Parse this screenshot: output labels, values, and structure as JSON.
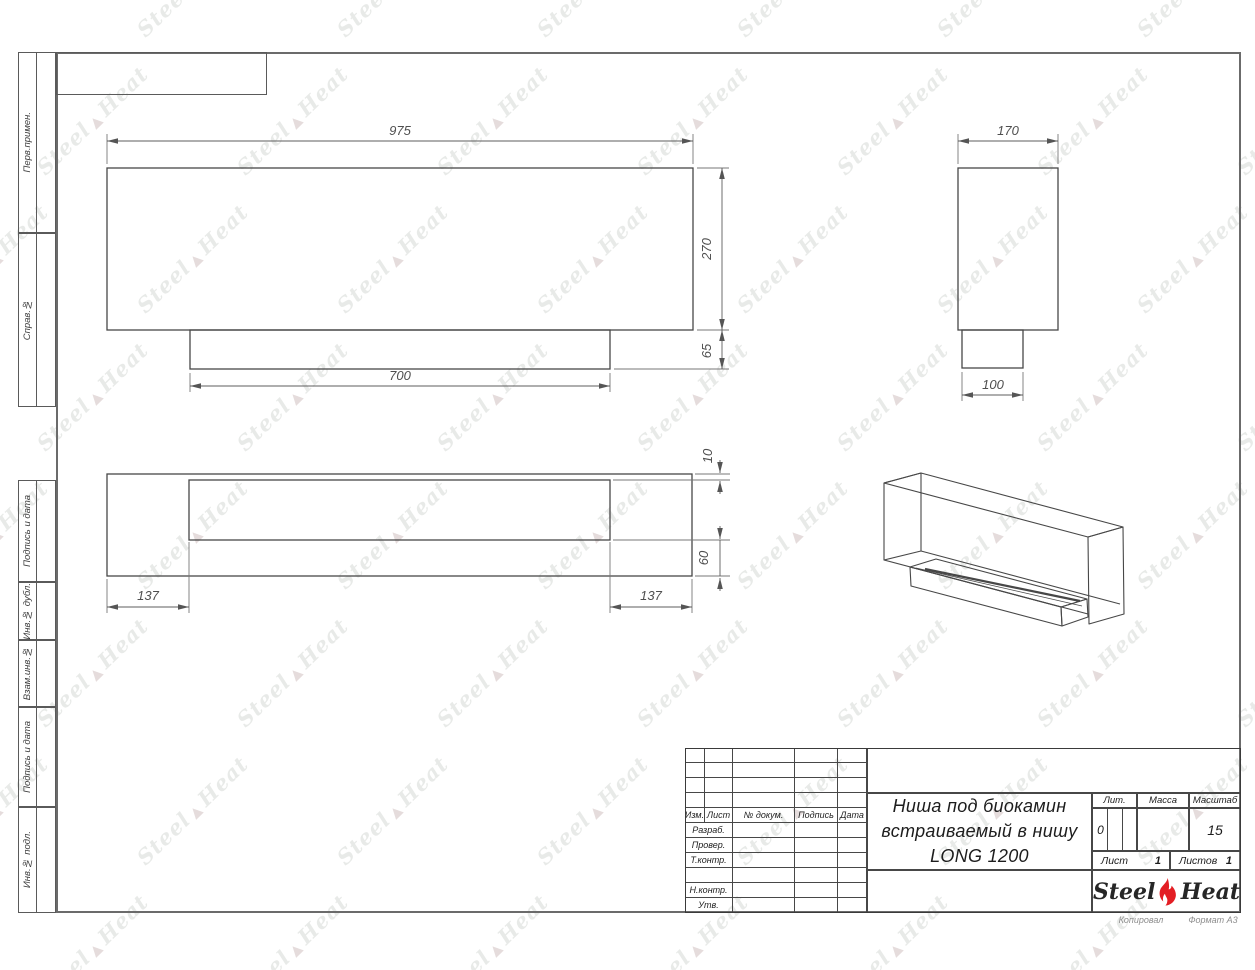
{
  "sheet": {
    "copied_note": "Копировал",
    "format_note": "Формат А3"
  },
  "side_labels": [
    "Перв.примен.",
    "Справ.№",
    "Подпись и дата",
    "Инв.№ дубл.",
    "Взам.инв.№",
    "Подпись и дата",
    "Инв.№ подл."
  ],
  "title_block": {
    "header": [
      "Изм.",
      "Лист",
      "№ докум.",
      "Подпись",
      "Дата"
    ],
    "sign_rows": [
      "Разраб.",
      "Провер.",
      "Т.контр.",
      "Н.контр.",
      "Утв."
    ],
    "title_lines": [
      "Ниша под биокамин",
      "встраиваемый в нишу",
      "LONG 1200"
    ],
    "lit_label": "Лит.",
    "lit_value": "0",
    "mass_label": "Масса",
    "mass_value": "",
    "scale_label": "Масштаб",
    "scale_value": "15",
    "sheet_label": "Лист",
    "sheet_value": "1",
    "sheets_label": "Листов",
    "sheets_value": "1"
  },
  "logo": {
    "steel": "Steel",
    "heat": "Heat",
    "flame_color": "#e31e24"
  },
  "watermark": {
    "steel": "Steel",
    "heat": "Heat"
  },
  "dims": {
    "front_width": "975",
    "front_height": "270",
    "base_height": "65",
    "base_width": "700",
    "side_depth": "170",
    "side_base_depth": "100",
    "top_margin_left": "137",
    "top_margin_right": "137",
    "top_lip": "10",
    "top_back": "60"
  }
}
